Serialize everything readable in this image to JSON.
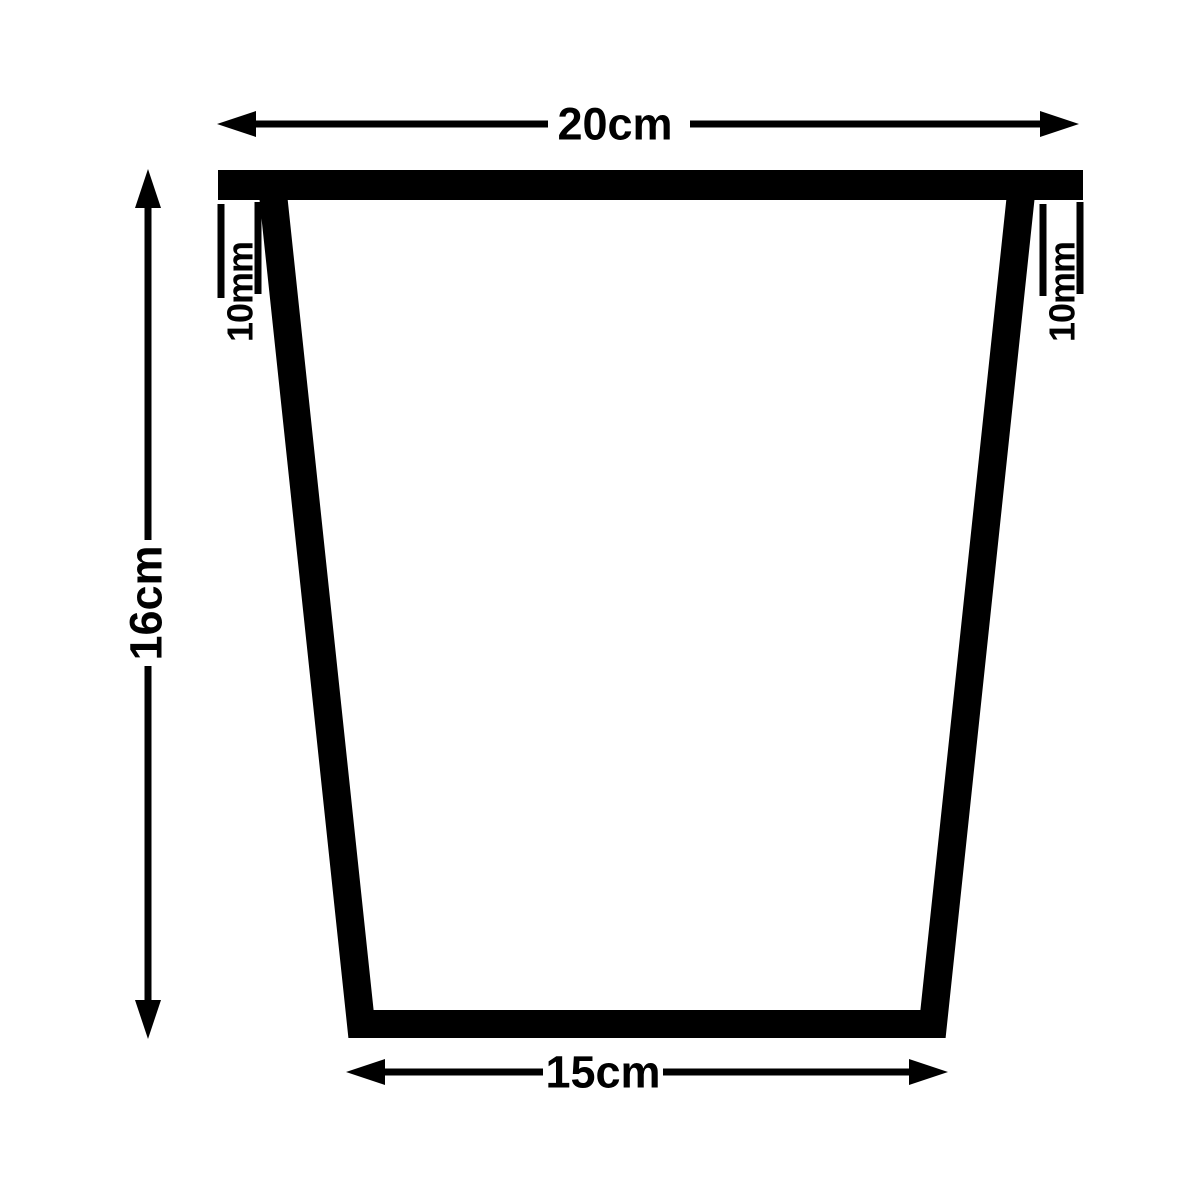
{
  "diagram": {
    "dimensions": {
      "top_width": "20cm",
      "height": "16cm",
      "bottom_width": "15cm",
      "wall_thickness_left": "10mm",
      "wall_thickness_right": "10mm"
    },
    "colors": {
      "line": "#000000",
      "background": "#ffffff"
    }
  }
}
